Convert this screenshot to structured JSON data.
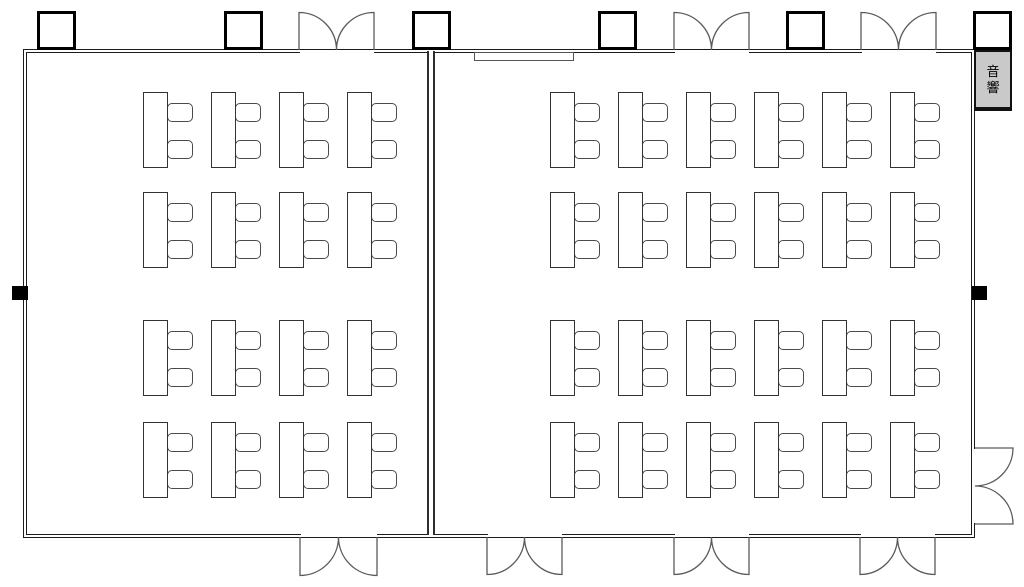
{
  "floor_plan": {
    "canvas": {
      "width": 1024,
      "height": 587,
      "background": "#ffffff"
    },
    "colors": {
      "wall": "#1c1c1c",
      "divider": "#2e2e2e",
      "door": "#5a5a5a",
      "table_border": "#333333",
      "chair_border": "#4a4a4a",
      "pillar_border": "#000000",
      "fill": "#ffffff",
      "booth_bg": "#c9c9c9",
      "booth_border": "#111111",
      "outlet": "#000000",
      "board_border": "#555555"
    },
    "room": {
      "x": 23,
      "y": 49,
      "width": 952,
      "height": 489,
      "inner_offset": 3
    },
    "divider": {
      "x": 427,
      "y": 51,
      "width": 8,
      "height": 484,
      "line_width": 2.5
    },
    "audio_booth": {
      "label": "音\n響",
      "x": 974,
      "y": 50,
      "width": 38,
      "height": 61
    },
    "wall_board": {
      "x": 474,
      "y": 52,
      "width": 100,
      "height": 9
    },
    "pillars": {
      "size": 39,
      "y": 11,
      "border": 3,
      "xs": [
        37,
        224,
        412,
        598,
        786,
        973
      ]
    },
    "doors": {
      "top": [
        {
          "x": 299,
          "w": 75
        },
        {
          "x": 674,
          "w": 75
        },
        {
          "x": 861,
          "w": 75
        }
      ],
      "bottom": [
        {
          "x": 300,
          "w": 77
        },
        {
          "x": 487,
          "w": 75
        },
        {
          "x": 674,
          "w": 75
        },
        {
          "x": 860,
          "w": 75
        }
      ],
      "right": [
        {
          "y": 448,
          "h": 76
        }
      ],
      "top_base": 50,
      "bottom_base": 537,
      "right_base": 975
    },
    "outlets": [
      {
        "side": "left",
        "x": 12,
        "y": 286,
        "w": 16,
        "h": 14
      },
      {
        "side": "right",
        "x": 972,
        "y": 286,
        "w": 15,
        "h": 14
      }
    ],
    "seating": {
      "table": {
        "w": 25,
        "h": 76
      },
      "chair": {
        "w": 26,
        "h": 19,
        "dx": 24,
        "dy1": 11,
        "dy2": 48,
        "radius": 5
      },
      "rooms": [
        {
          "name": "left-room",
          "cols": [
            143,
            211,
            279,
            347
          ],
          "rows": [
            92,
            192,
            320,
            422
          ]
        },
        {
          "name": "right-room",
          "cols": [
            550,
            618,
            686,
            754,
            822,
            890
          ],
          "rows": [
            92,
            192,
            320,
            422
          ]
        }
      ]
    }
  }
}
